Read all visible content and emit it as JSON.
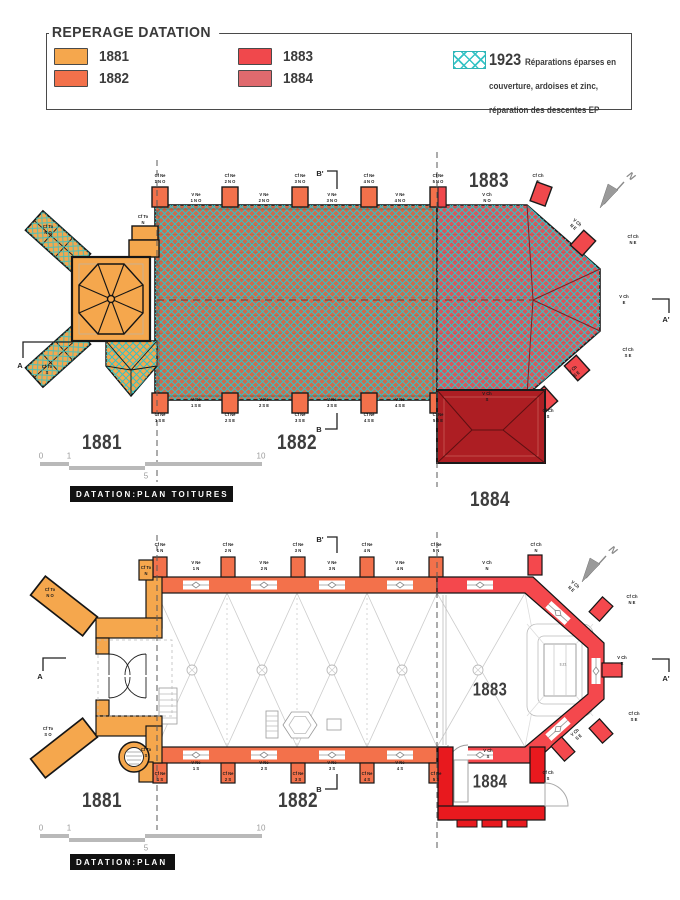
{
  "colors": {
    "accent_1881": "#F5A74D",
    "accent_1882": "#F3714B",
    "accent_1883": "#F0484C",
    "accent_1884": "#E06A6E",
    "roof_1882_base": "#CE6B4C",
    "roof_1883_base": "#D9565B",
    "roof_1884": "#AD1E23",
    "plan_1883": "#F4484D",
    "plan_1884": "#E8191E",
    "hatch": "#35C3C5",
    "title_box_bg": "#111111",
    "drawing_gray": "#c9c9c9",
    "scale_gray": "#b9b9b9"
  },
  "legend": {
    "title": "REPERAGE DATATION",
    "items": [
      {
        "year": "1881",
        "color": "#F5A74D"
      },
      {
        "year": "1882",
        "color": "#F3714B"
      },
      {
        "year": "1883",
        "color": "#F0484C"
      },
      {
        "year": "1884",
        "color": "#E06A6E"
      }
    ],
    "repair": {
      "year": "1923",
      "text": "Réparations éparses en couverture, ardoises et zinc, réparation des descentes EP"
    }
  },
  "compass": {
    "label": "N"
  },
  "scale_bar": {
    "n0": "0",
    "n1": "1",
    "n5": "5",
    "n10": "10"
  },
  "roof_plan": {
    "title": "DATATION:PLAN TOITURES",
    "year_zones": {
      "z1881": "1881",
      "z1882": "1882",
      "z1883": "1883",
      "z1884": "1884"
    },
    "sections": {
      "a": "A",
      "a_prime": "A'",
      "b": "B",
      "b_prime": "B'"
    },
    "annotations": [
      {
        "t": "Cf Ne\n1 N O",
        "x": 160,
        "y": 179
      },
      {
        "t": "V Ne\n1 N O",
        "x": 196,
        "y": 198
      },
      {
        "t": "Cf Ne\n2 N O",
        "x": 230,
        "y": 179
      },
      {
        "t": "V Ne\n2 N O",
        "x": 264,
        "y": 198
      },
      {
        "t": "Cf Ne\n3 N O",
        "x": 300,
        "y": 179
      },
      {
        "t": "V Ne\n3 N O",
        "x": 332,
        "y": 198
      },
      {
        "t": "Cf Ne\n4 N O",
        "x": 369,
        "y": 179
      },
      {
        "t": "V Ne\n4 N O",
        "x": 400,
        "y": 198
      },
      {
        "t": "Cf Ne\n5 N O",
        "x": 438,
        "y": 179
      },
      {
        "t": "V Ch\nN O",
        "x": 487,
        "y": 198
      },
      {
        "t": "Cf Ch\nN",
        "x": 538,
        "y": 179
      },
      {
        "t": "V Ch\nN E",
        "x": 575,
        "y": 225,
        "r": 40
      },
      {
        "t": "Cf Ch\nN E",
        "x": 633,
        "y": 240
      },
      {
        "t": "V Ch\nE",
        "x": 624,
        "y": 300
      },
      {
        "t": "Cf Ch\nS E",
        "x": 628,
        "y": 353
      },
      {
        "t": "V Ch\nS E",
        "x": 575,
        "y": 372,
        "r": -40
      },
      {
        "t": "V Ch\nS",
        "x": 487,
        "y": 397
      },
      {
        "t": "Cf Ch\nS",
        "x": 548,
        "y": 414
      },
      {
        "t": "Cf Ne\n1 S E",
        "x": 160,
        "y": 418
      },
      {
        "t": "V Ne\n1 S E",
        "x": 196,
        "y": 403
      },
      {
        "t": "Cf Ne\n2 S E",
        "x": 230,
        "y": 418
      },
      {
        "t": "V Ne\n2 S E",
        "x": 264,
        "y": 403
      },
      {
        "t": "Cf Ne\n3 S E",
        "x": 300,
        "y": 418
      },
      {
        "t": "V Ne\n3 S E",
        "x": 332,
        "y": 403
      },
      {
        "t": "Cf Ne\n4 S E",
        "x": 369,
        "y": 418
      },
      {
        "t": "V Ne\n4 S E",
        "x": 400,
        "y": 403
      },
      {
        "t": "Cf Ne\n5 S E",
        "x": 438,
        "y": 418
      },
      {
        "t": "Cf To\nN O",
        "x": 48,
        "y": 230
      },
      {
        "t": "Cf To\nN",
        "x": 143,
        "y": 220
      },
      {
        "t": "Cf To\nS",
        "x": 47,
        "y": 370
      }
    ]
  },
  "floor_plan": {
    "title": "DATATION:PLAN",
    "year_zones": {
      "z1881": "1881",
      "z1882": "1882",
      "z1883": "1883",
      "z1884": "1884"
    },
    "sections": {
      "a": "A",
      "a_prime": "A'",
      "b": "B",
      "b_prime": "B'"
    },
    "annotations": [
      {
        "t": "Cf Ne\n1 N",
        "x": 160,
        "y": 548
      },
      {
        "t": "V Ne\n1 N",
        "x": 196,
        "y": 566
      },
      {
        "t": "Cf Ne\n2 N",
        "x": 228,
        "y": 548
      },
      {
        "t": "V Ne\n2 N",
        "x": 264,
        "y": 566
      },
      {
        "t": "Cf Ne\n3 N",
        "x": 298,
        "y": 548
      },
      {
        "t": "V Ne\n3 N",
        "x": 332,
        "y": 566
      },
      {
        "t": "Cf Ne\n4 N",
        "x": 367,
        "y": 548
      },
      {
        "t": "V Ne\n4 N",
        "x": 400,
        "y": 566
      },
      {
        "t": "Cf Ne\n5 N",
        "x": 436,
        "y": 548
      },
      {
        "t": "Cf To\nN O",
        "x": 50,
        "y": 593
      },
      {
        "t": "Cf To\nN",
        "x": 146,
        "y": 571
      },
      {
        "t": "Cf To\nS O",
        "x": 48,
        "y": 732
      },
      {
        "t": "Cf To\nS",
        "x": 146,
        "y": 753
      },
      {
        "t": "V Ch\nN",
        "x": 487,
        "y": 566
      },
      {
        "t": "Cf Ch\nN",
        "x": 536,
        "y": 548
      },
      {
        "t": "V Ch\nN E",
        "x": 573,
        "y": 587,
        "r": 40
      },
      {
        "t": "Cf Ch\nN E",
        "x": 632,
        "y": 600
      },
      {
        "t": "V Ch\nE",
        "x": 622,
        "y": 661
      },
      {
        "t": "Cf Ch\nS E",
        "x": 634,
        "y": 717
      },
      {
        "t": "V Ch\nS E",
        "x": 577,
        "y": 735,
        "r": -40
      },
      {
        "t": "V Ch\nS",
        "x": 488,
        "y": 754
      },
      {
        "t": "Cf Ch\nS",
        "x": 548,
        "y": 776
      },
      {
        "t": "Cf Ne\n1 S",
        "x": 160,
        "y": 777
      },
      {
        "t": "V Ne\n1 S",
        "x": 196,
        "y": 766
      },
      {
        "t": "Cf Ne\n2 S",
        "x": 228,
        "y": 777
      },
      {
        "t": "V Ne\n2 S",
        "x": 264,
        "y": 766
      },
      {
        "t": "Cf Ne\n3 S",
        "x": 298,
        "y": 777
      },
      {
        "t": "V Ne\n3 S",
        "x": 332,
        "y": 766
      },
      {
        "t": "Cf Ne\n4 S",
        "x": 367,
        "y": 777
      },
      {
        "t": "V Ne\n4 S",
        "x": 400,
        "y": 766
      },
      {
        "t": "Cf Ne\n5 S",
        "x": 436,
        "y": 777
      },
      {
        "t": "3.21",
        "x": 563,
        "y": 664,
        "fs": 4,
        "c": "#8a8a8a"
      }
    ]
  }
}
